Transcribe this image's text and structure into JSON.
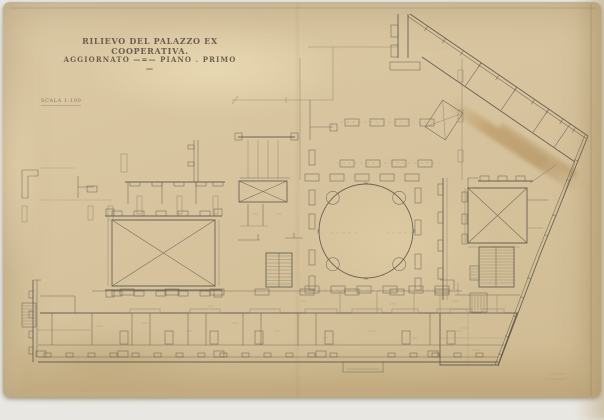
{
  "document": {
    "title_line1": "RILIEVO DEL PALAZZO EX COOPERATIVA.",
    "title_line2": "AGGIORNATO —=— PIANO . PRIMO —",
    "scale_label": "SCALA 1:100",
    "colors": {
      "paper": "#d7c49e",
      "paper_edge": "#cfba92",
      "ink": "#575045",
      "faint_ink": "#8d8069",
      "stain_brown": "#a97c3e",
      "scan_background": "#e9e7e1"
    }
  }
}
